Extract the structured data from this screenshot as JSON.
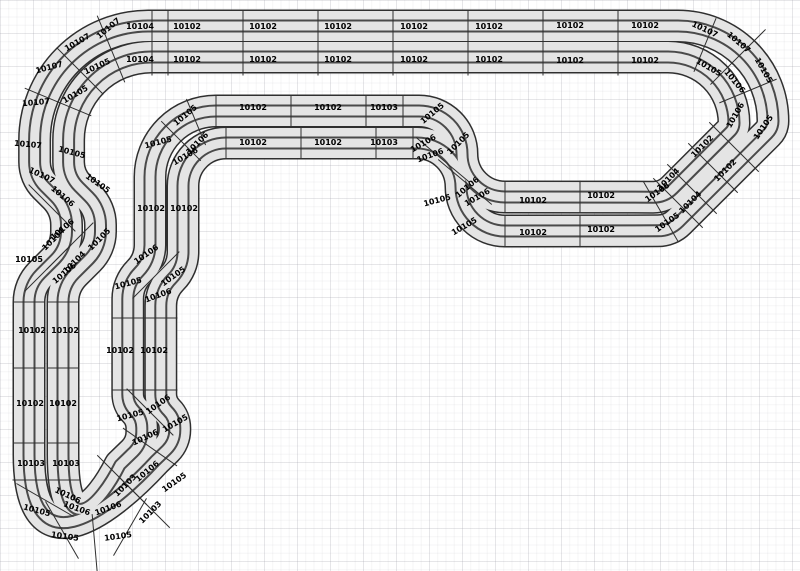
{
  "app": {
    "view": "track-plan-canvas",
    "description_parts_catalog": [
      "10102",
      "10103",
      "10104",
      "10105",
      "10106",
      "10107"
    ]
  },
  "canvas": {
    "width": 800,
    "height": 571,
    "background": "#ffffff",
    "grid_minor_px": 8,
    "grid_major_px": 33
  },
  "track": {
    "surface_color": "#e4e4e4",
    "border_color": "#2f2f2f",
    "slot_color": "#4a4a4a",
    "joint_color": "#2f2f2f",
    "band_width_px": 33,
    "piece_labels": [
      {
        "t": "10104",
        "x": 140,
        "y": 26,
        "r": 0
      },
      {
        "t": "10102",
        "x": 187,
        "y": 26,
        "r": 0
      },
      {
        "t": "10102",
        "x": 263,
        "y": 26,
        "r": 0
      },
      {
        "t": "10102",
        "x": 338,
        "y": 26,
        "r": 0
      },
      {
        "t": "10102",
        "x": 414,
        "y": 26,
        "r": 0
      },
      {
        "t": "10102",
        "x": 489,
        "y": 26,
        "r": 0
      },
      {
        "t": "10102",
        "x": 570,
        "y": 25,
        "r": 0
      },
      {
        "t": "10102",
        "x": 645,
        "y": 25,
        "r": 0
      },
      {
        "t": "10104",
        "x": 140,
        "y": 59,
        "r": 0
      },
      {
        "t": "10102",
        "x": 187,
        "y": 59,
        "r": 0
      },
      {
        "t": "10102",
        "x": 263,
        "y": 59,
        "r": 0
      },
      {
        "t": "10102",
        "x": 338,
        "y": 59,
        "r": 0
      },
      {
        "t": "10102",
        "x": 414,
        "y": 59,
        "r": 0
      },
      {
        "t": "10102",
        "x": 489,
        "y": 59,
        "r": 0
      },
      {
        "t": "10102",
        "x": 570,
        "y": 60,
        "r": 0
      },
      {
        "t": "10102",
        "x": 645,
        "y": 60,
        "r": 0
      },
      {
        "t": "10107",
        "x": 108,
        "y": 28,
        "r": -40
      },
      {
        "t": "10107",
        "x": 77,
        "y": 42,
        "r": -30
      },
      {
        "t": "10107",
        "x": 49,
        "y": 67,
        "r": -15
      },
      {
        "t": "10105",
        "x": 97,
        "y": 66,
        "r": -25
      },
      {
        "t": "10105",
        "x": 75,
        "y": 94,
        "r": -30
      },
      {
        "t": "10107",
        "x": 36,
        "y": 102,
        "r": -5
      },
      {
        "t": "10107",
        "x": 28,
        "y": 144,
        "r": 5
      },
      {
        "t": "10105",
        "x": 72,
        "y": 152,
        "r": 15
      },
      {
        "t": "10107",
        "x": 42,
        "y": 175,
        "r": 25
      },
      {
        "t": "10105",
        "x": 98,
        "y": 183,
        "r": 35
      },
      {
        "t": "10106",
        "x": 63,
        "y": 196,
        "r": 40
      },
      {
        "t": "10106",
        "x": 62,
        "y": 229,
        "r": -40
      },
      {
        "t": "10104",
        "x": 53,
        "y": 239,
        "r": -45
      },
      {
        "t": "10105",
        "x": 99,
        "y": 239,
        "r": -45
      },
      {
        "t": "10105",
        "x": 29,
        "y": 259,
        "r": 0
      },
      {
        "t": "10104",
        "x": 74,
        "y": 262,
        "r": -45
      },
      {
        "t": "10106",
        "x": 64,
        "y": 273,
        "r": -40
      },
      {
        "t": "10102",
        "x": 32,
        "y": 330,
        "r": 0
      },
      {
        "t": "10102",
        "x": 65,
        "y": 330,
        "r": 0
      },
      {
        "t": "10102",
        "x": 30,
        "y": 403,
        "r": 0
      },
      {
        "t": "10102",
        "x": 63,
        "y": 403,
        "r": 0
      },
      {
        "t": "10103",
        "x": 31,
        "y": 463,
        "r": 0
      },
      {
        "t": "10103",
        "x": 66,
        "y": 463,
        "r": 0
      },
      {
        "t": "10106",
        "x": 68,
        "y": 495,
        "r": 25
      },
      {
        "t": "10105",
        "x": 37,
        "y": 510,
        "r": 15
      },
      {
        "t": "10106",
        "x": 77,
        "y": 508,
        "r": 20
      },
      {
        "t": "10106",
        "x": 108,
        "y": 508,
        "r": -20
      },
      {
        "t": "10105",
        "x": 65,
        "y": 536,
        "r": 8
      },
      {
        "t": "10105",
        "x": 118,
        "y": 536,
        "r": -8
      },
      {
        "t": "10103",
        "x": 125,
        "y": 485,
        "r": -45
      },
      {
        "t": "10103",
        "x": 150,
        "y": 512,
        "r": -45
      },
      {
        "t": "10106",
        "x": 147,
        "y": 471,
        "r": -40
      },
      {
        "t": "10105",
        "x": 174,
        "y": 482,
        "r": -35
      },
      {
        "t": "10106",
        "x": 158,
        "y": 404,
        "r": -35
      },
      {
        "t": "10105",
        "x": 130,
        "y": 415,
        "r": -15
      },
      {
        "t": "10105",
        "x": 175,
        "y": 423,
        "r": -30
      },
      {
        "t": "10106",
        "x": 145,
        "y": 437,
        "r": -25
      },
      {
        "t": "10102",
        "x": 120,
        "y": 350,
        "r": 0
      },
      {
        "t": "10102",
        "x": 154,
        "y": 350,
        "r": 0
      },
      {
        "t": "10106",
        "x": 146,
        "y": 254,
        "r": -35
      },
      {
        "t": "10105",
        "x": 128,
        "y": 283,
        "r": -15
      },
      {
        "t": "10105",
        "x": 173,
        "y": 276,
        "r": -35
      },
      {
        "t": "10106",
        "x": 158,
        "y": 295,
        "r": -20
      },
      {
        "t": "10102",
        "x": 151,
        "y": 208,
        "r": 0
      },
      {
        "t": "10102",
        "x": 184,
        "y": 208,
        "r": 0
      },
      {
        "t": "10105",
        "x": 185,
        "y": 115,
        "r": -40
      },
      {
        "t": "10105",
        "x": 158,
        "y": 142,
        "r": -15
      },
      {
        "t": "10106",
        "x": 197,
        "y": 143,
        "r": -45
      },
      {
        "t": "10106",
        "x": 185,
        "y": 156,
        "r": -30
      },
      {
        "t": "10102",
        "x": 253,
        "y": 107,
        "r": 0
      },
      {
        "t": "10102",
        "x": 328,
        "y": 107,
        "r": 0
      },
      {
        "t": "10103",
        "x": 384,
        "y": 107,
        "r": 0
      },
      {
        "t": "10102",
        "x": 253,
        "y": 142,
        "r": 0
      },
      {
        "t": "10102",
        "x": 328,
        "y": 142,
        "r": 0
      },
      {
        "t": "10103",
        "x": 384,
        "y": 142,
        "r": 0
      },
      {
        "t": "10105",
        "x": 432,
        "y": 113,
        "r": -40
      },
      {
        "t": "10106",
        "x": 423,
        "y": 143,
        "r": -30
      },
      {
        "t": "10105",
        "x": 458,
        "y": 143,
        "r": -45
      },
      {
        "t": "10106",
        "x": 430,
        "y": 155,
        "r": -20
      },
      {
        "t": "10106",
        "x": 467,
        "y": 187,
        "r": -40
      },
      {
        "t": "10106",
        "x": 477,
        "y": 197,
        "r": -30
      },
      {
        "t": "10105",
        "x": 437,
        "y": 200,
        "r": -15
      },
      {
        "t": "10105",
        "x": 464,
        "y": 226,
        "r": -30
      },
      {
        "t": "10102",
        "x": 533,
        "y": 200,
        "r": 0
      },
      {
        "t": "10102",
        "x": 601,
        "y": 195,
        "r": 0
      },
      {
        "t": "10102",
        "x": 533,
        "y": 232,
        "r": 0
      },
      {
        "t": "10102",
        "x": 601,
        "y": 229,
        "r": 0
      },
      {
        "t": "10104",
        "x": 668,
        "y": 179,
        "r": -45
      },
      {
        "t": "10106",
        "x": 657,
        "y": 192,
        "r": -35
      },
      {
        "t": "10104",
        "x": 690,
        "y": 202,
        "r": -45
      },
      {
        "t": "10105",
        "x": 667,
        "y": 222,
        "r": -35
      },
      {
        "t": "10102",
        "x": 702,
        "y": 146,
        "r": -45
      },
      {
        "t": "10102",
        "x": 725,
        "y": 170,
        "r": -45
      },
      {
        "t": "10107",
        "x": 705,
        "y": 29,
        "r": 25
      },
      {
        "t": "10107",
        "x": 739,
        "y": 42,
        "r": 40
      },
      {
        "t": "10105",
        "x": 709,
        "y": 67,
        "r": 30
      },
      {
        "t": "10105",
        "x": 764,
        "y": 70,
        "r": 60
      },
      {
        "t": "10106",
        "x": 735,
        "y": 81,
        "r": 50
      },
      {
        "t": "10106",
        "x": 735,
        "y": 115,
        "r": -60
      },
      {
        "t": "10105",
        "x": 763,
        "y": 127,
        "r": -55
      }
    ]
  }
}
